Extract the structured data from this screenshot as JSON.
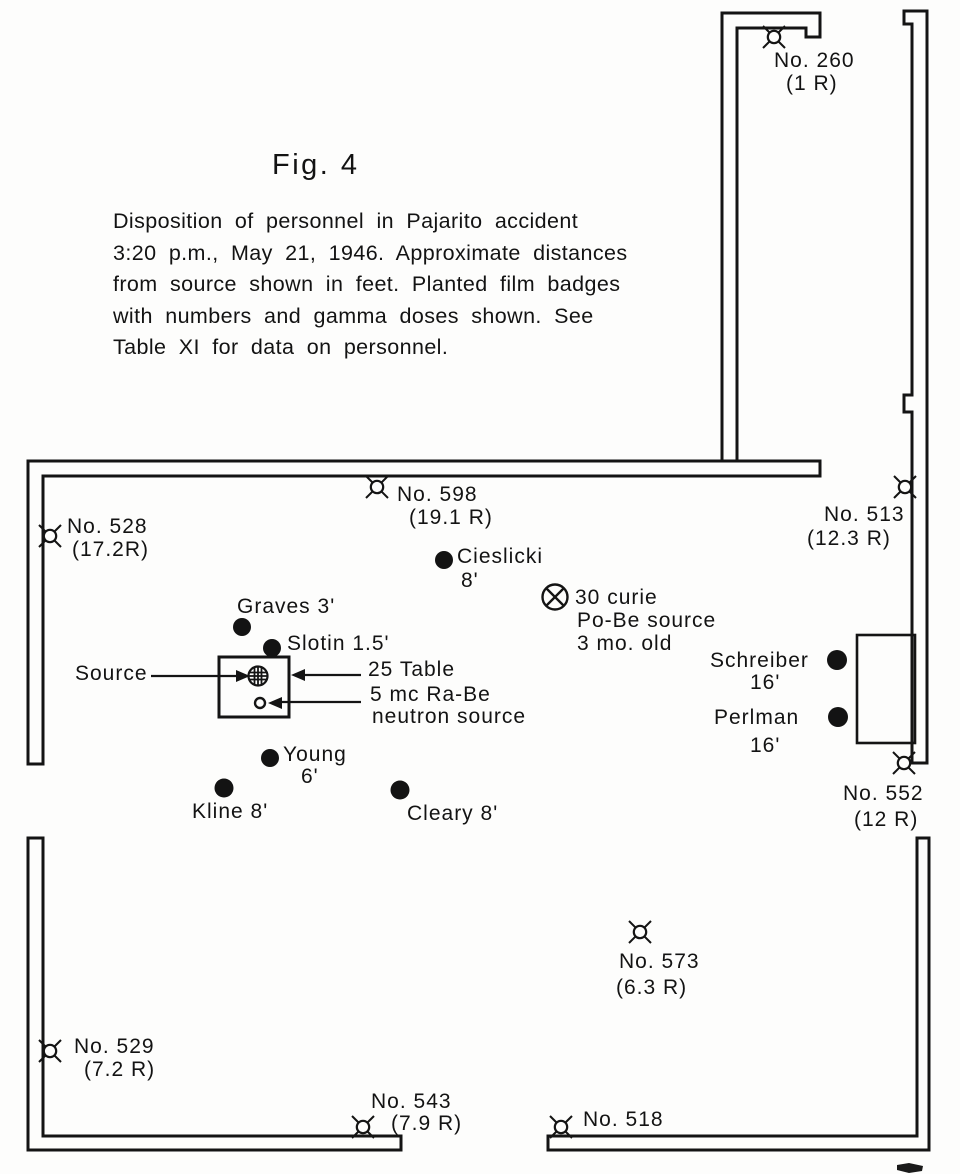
{
  "figure": {
    "title": "Fig. 4",
    "caption": [
      "Disposition of personnel in Pajarito accident",
      "3:20 p.m., May 21, 1946. Approximate distances",
      "from source shown in feet. Planted film badges",
      "with numbers and gamma doses shown. See",
      "Table XI for data on personnel."
    ]
  },
  "film_badges": {
    "b260": {
      "number": "No. 260",
      "dose": "(1 R)"
    },
    "b528": {
      "number": "No. 528",
      "dose": "(17.2R)"
    },
    "b598": {
      "number": "No. 598",
      "dose": "(19.1 R)"
    },
    "b513": {
      "number": "No. 513",
      "dose": "(12.3 R)"
    },
    "b552": {
      "number": "No. 552",
      "dose": "(12 R)"
    },
    "b573": {
      "number": "No. 573",
      "dose": "(6.3 R)"
    },
    "b529": {
      "number": "No. 529",
      "dose": "(7.2 R)"
    },
    "b543": {
      "number": "No. 543",
      "dose": "(7.9 R)"
    },
    "b518": {
      "number": "No. 518"
    }
  },
  "personnel": {
    "cieslicki": {
      "name": "Cieslicki",
      "distance": "8'"
    },
    "graves": {
      "label": "Graves 3'"
    },
    "slotin": {
      "label": "Slotin 1.5'"
    },
    "young": {
      "name": "Young",
      "distance": "6'"
    },
    "kline": {
      "label": "Kline 8'"
    },
    "cleary": {
      "label": "Cleary 8'"
    },
    "schreiber": {
      "name": "Schreiber",
      "distance": "16'"
    },
    "perlman": {
      "name": "Perlman",
      "distance": "16'"
    }
  },
  "annotations": {
    "source": "Source",
    "table": "25 Table",
    "neutron_source_line1": "5 mc Ra-Be",
    "neutron_source_line2": "neutron source",
    "pobe_line1": "30 curie",
    "pobe_line2": "Po-Be source",
    "pobe_line3": "3 mo. old"
  },
  "colors": {
    "ink": "#131313",
    "paper": "#fdfdfc"
  }
}
